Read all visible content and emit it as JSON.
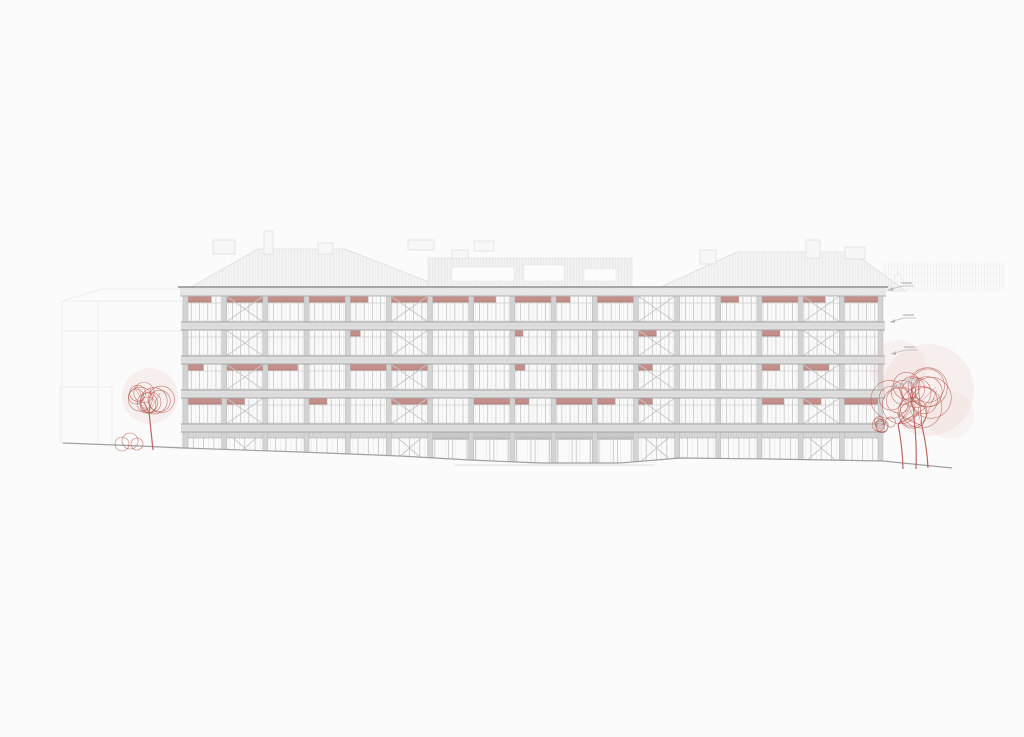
{
  "scene": {
    "width": 1024,
    "height": 737,
    "background": "#fbfbfb",
    "description_name": "architectural-elevation-drawing"
  },
  "palette": {
    "slab": "#dedede",
    "slab_edge": "#a5a5a5",
    "parapet": "#e7e7e7",
    "parapet_top": "#8f8f8f",
    "parapet_bottom": "#b2b2b2",
    "column": "#d3d3d3",
    "column_edge": "#b7b7b7",
    "glass": "#fafafa",
    "mullion": "#c3c3c3",
    "mullion_minor": "#e3e3e3",
    "transom": "#cfcfcf",
    "blind": "#c48e8a",
    "blind_edge": "#a96f6a",
    "brace": "#c7c7c7",
    "roof_fill": "#f3f3f3",
    "roof_edge": "#e1e1e1",
    "bg_line": "#eaeaea",
    "bg_line_faint": "#f0f0f0",
    "ground": "#a0a0a0",
    "ground_faint": "#d2d2d2",
    "tree": "#b5574f",
    "tree_wash": "#eac3bf",
    "marker": "#b9b9b9",
    "marker_text": "#d0d0d0",
    "storefront_band": "#d9d9d9",
    "entrance_band": "#c9c9c9"
  },
  "building": {
    "left": 183,
    "top": 287,
    "width": 700,
    "bays": 17,
    "parapet_h": 9,
    "rows_y": [
      296,
      330,
      364,
      398
    ],
    "row_h": 26,
    "slab_h": 8,
    "columns_top": 296,
    "columns_bottom": 464,
    "ground": {
      "y": 432,
      "bottom": 464,
      "band_h": 6,
      "entrance_band_h": 8,
      "entrance_bays": [
        6,
        7,
        8,
        9,
        10
      ]
    },
    "brace_bays": [
      1,
      5,
      11,
      15
    ],
    "mullions_main": [
      0.2,
      0.4,
      0.6,
      0.8
    ],
    "mullions_minor": [
      0.1,
      0.3,
      0.5,
      0.7,
      0.9
    ],
    "blinds_rows": [
      [
        0.7,
        1,
        1,
        1,
        0.5,
        1,
        1,
        0.6,
        1,
        0.4,
        1,
        0,
        0,
        0.5,
        1,
        0.6,
        1
      ],
      [
        0,
        0,
        0,
        0,
        0.3,
        0,
        0,
        0,
        0.25,
        0,
        0,
        0.5,
        0,
        0,
        0.5,
        0,
        0
      ],
      [
        0.5,
        1,
        0.8,
        0,
        1,
        1,
        0,
        0,
        0.3,
        0,
        0,
        0.4,
        0,
        0,
        0.5,
        0.7,
        0
      ],
      [
        1,
        0.5,
        0,
        0.5,
        0,
        1,
        0,
        1,
        0.4,
        1,
        0.5,
        0.4,
        0,
        0,
        0.6,
        0.5,
        1
      ]
    ]
  },
  "background": {
    "left_blocks": [
      {
        "x": 62,
        "y": 301,
        "w": 120,
        "h": 146
      },
      {
        "x": 60,
        "y": 387,
        "w": 52,
        "h": 58
      }
    ],
    "left_block_lines": [
      [
        62,
        331,
        182,
        331
      ],
      [
        98,
        301,
        98,
        447
      ],
      [
        62,
        301,
        102,
        289
      ],
      [
        102,
        289,
        182,
        289
      ]
    ],
    "roofs": [
      {
        "pts": [
          [
            184,
            291
          ],
          [
            258,
            249
          ],
          [
            345,
            249
          ],
          [
            452,
            291
          ]
        ]
      },
      {
        "pts": [
          [
            652,
            291
          ],
          [
            737,
            252
          ],
          [
            852,
            252
          ],
          [
            906,
            291
          ]
        ]
      }
    ],
    "chimneys": [
      {
        "x": 213,
        "y": 240,
        "w": 22,
        "h": 14
      },
      {
        "x": 264,
        "y": 231,
        "w": 9,
        "h": 23
      },
      {
        "x": 318,
        "y": 243,
        "w": 15,
        "h": 11
      },
      {
        "x": 408,
        "y": 240,
        "w": 26,
        "h": 10
      },
      {
        "x": 474,
        "y": 241,
        "w": 20,
        "h": 10
      },
      {
        "x": 452,
        "y": 250,
        "w": 16,
        "h": 9
      },
      {
        "x": 700,
        "y": 250,
        "w": 16,
        "h": 14
      },
      {
        "x": 806,
        "y": 240,
        "w": 14,
        "h": 18
      },
      {
        "x": 845,
        "y": 247,
        "w": 20,
        "h": 12
      }
    ],
    "penthouse": {
      "x": 428,
      "y": 258,
      "w": 204,
      "h": 33,
      "windows": [
        {
          "x": 452,
          "y": 267,
          "w": 62,
          "h": 14
        },
        {
          "x": 524,
          "y": 265,
          "w": 40,
          "h": 16
        },
        {
          "x": 584,
          "y": 269,
          "w": 32,
          "h": 12
        }
      ]
    },
    "right_band": {
      "x": 884,
      "y": 262,
      "w": 120,
      "h": 29,
      "lines_y": [
        266,
        274,
        282
      ]
    },
    "gable": [
      [
        888,
        290
      ],
      [
        898,
        272
      ],
      [
        908,
        290
      ]
    ]
  },
  "terrain": {
    "line": [
      [
        63,
        443
      ],
      [
        140,
        446
      ],
      [
        183,
        448
      ],
      [
        300,
        452
      ],
      [
        400,
        456
      ],
      [
        470,
        460
      ],
      [
        540,
        463
      ],
      [
        620,
        463
      ],
      [
        680,
        458
      ],
      [
        770,
        459
      ],
      [
        883,
        461
      ],
      [
        952,
        468
      ]
    ],
    "second_line": [
      [
        455,
        465
      ],
      [
        655,
        465
      ]
    ]
  },
  "trees": {
    "left": {
      "trunk_base": [
        153,
        450
      ],
      "trunk_top": [
        149,
        412
      ],
      "canopy": {
        "cx": 147,
        "cy": 396,
        "r": 26,
        "n": 10,
        "seed": 7
      },
      "wash": [
        {
          "cx": 150,
          "cy": 396,
          "r": 28,
          "o": 0.22
        }
      ],
      "bush": {
        "cx": 129,
        "cy": 443,
        "circles": [
          [
            -7,
            1,
            7
          ],
          [
            1,
            -2,
            8
          ],
          [
            8,
            1,
            6
          ]
        ]
      }
    },
    "right": {
      "trunks": [
        [
          903,
          469,
          898,
          424
        ],
        [
          916,
          469,
          914,
          418
        ],
        [
          928,
          468,
          922,
          426
        ]
      ],
      "canopy": {
        "cx": 913,
        "cy": 398,
        "r": 40,
        "n": 16,
        "seed": 21
      },
      "sub_canopy": {
        "cx": 884,
        "cy": 424,
        "r": 14,
        "n": 6,
        "seed": 4
      },
      "wash": [
        {
          "cx": 928,
          "cy": 390,
          "r": 46,
          "o": 0.2
        },
        {
          "cx": 898,
          "cy": 368,
          "r": 28,
          "o": 0.16
        },
        {
          "cx": 950,
          "cy": 415,
          "r": 24,
          "o": 0.14
        }
      ]
    }
  },
  "level_markers": [
    {
      "x": 888,
      "y": 290
    },
    {
      "x": 890,
      "y": 322
    },
    {
      "x": 891,
      "y": 354
    },
    {
      "x": 892,
      "y": 387
    }
  ]
}
